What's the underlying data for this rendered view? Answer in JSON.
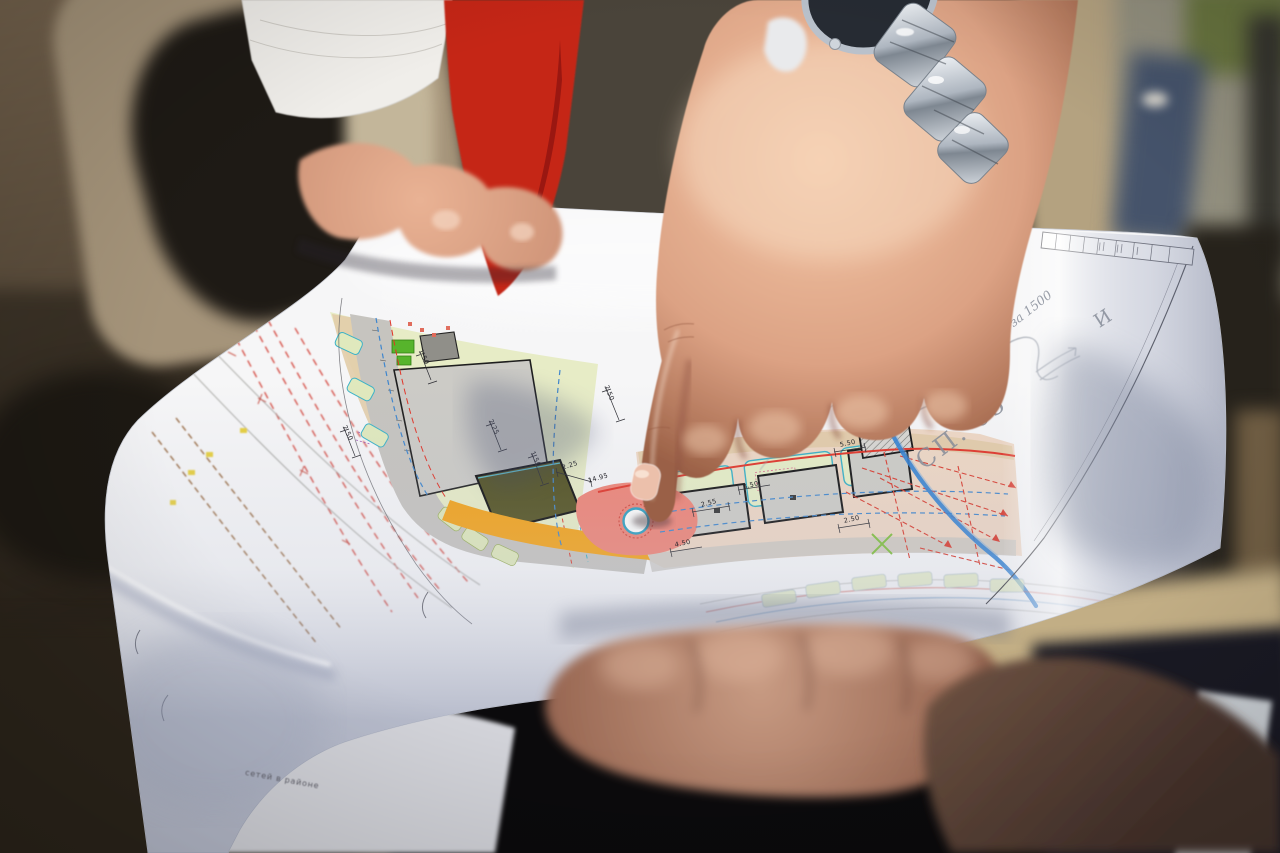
{
  "scene": {
    "type": "photograph",
    "description": "Sunlit outdoor review of a printed color urban site plan; one person holds the unfolded sheet while another hand with a silver wristwatch points an index finger at a circular plaza on the drawing"
  },
  "paper": {
    "kind": "site plan printout",
    "handwritten_notes": [
      "СП. 05",
      "за 1500",
      "И"
    ],
    "printed_caption": "сетей в районе",
    "dimension_labels": [
      "2.25",
      "14.95",
      "2.55",
      "2.50",
      "5.50",
      "1.50",
      "2.50",
      "4.50",
      "2.25",
      "1.50",
      "3.50",
      "2.50"
    ]
  },
  "plan_colors": {
    "lawn_green": "#e7ecc6",
    "playground_green": "#57b42c",
    "road_gray": "#c6c4bf",
    "building_gray": "#cccbc6",
    "olive_roof": "#52511f",
    "plaza_pink": "#ef8476",
    "paving_orange": "#f4a318",
    "utility_red": "#da3a2c",
    "utility_blue": "#3f86cd",
    "marker_blue": "#2f80d2",
    "teal_outline": "#38b0c6",
    "utility_brown": "#8a5526"
  },
  "objects": {
    "wristwatch": "silver bracelet watch",
    "folder": "red folder",
    "sleeve": "khaki jacket"
  }
}
